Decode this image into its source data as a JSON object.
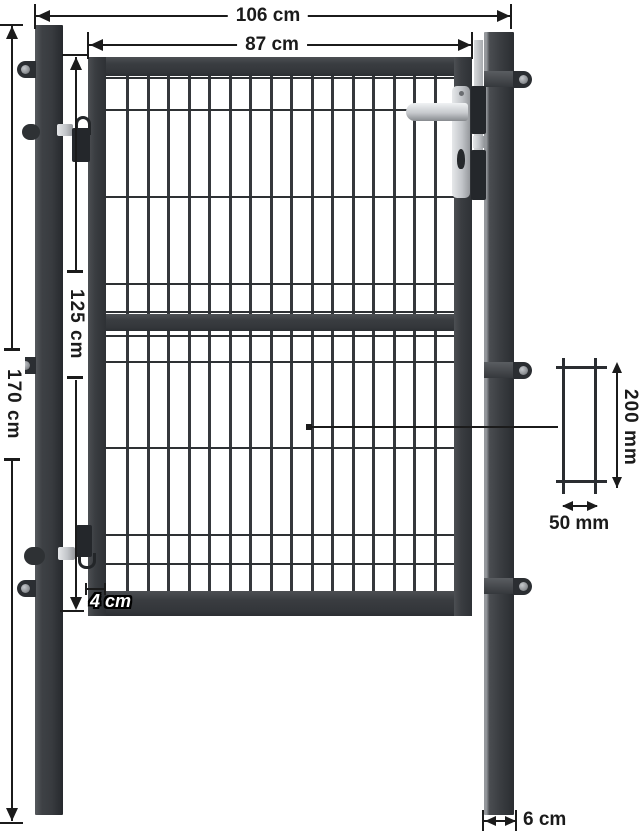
{
  "product": {
    "name": "Garden gate with two square posts and double-wire mesh infill",
    "view": "front elevation dimension diagram",
    "finish": "anthracite gray"
  },
  "labels": {
    "total_width": "106 cm",
    "gate_width": "87 cm",
    "post_height": "170 cm",
    "gate_height": "125 cm",
    "frame_tube_width": "4 cm",
    "post_width": "6 cm",
    "mesh_cell_height": "200 mm",
    "mesh_cell_width": "50 mm"
  },
  "colors": {
    "background": "#ffffff",
    "steel_dark": "#3b3e42",
    "steel_darker": "#2b2e32",
    "mesh_wire": "#2e3134",
    "silver_hardware": "#c9ccd0",
    "dimension_ink": "#1b1b1b",
    "outlined_label_fill": "#ffffff"
  },
  "mesh": {
    "vertical_bar_count": 16,
    "horizontal_wire_offsets": [
      1,
      33,
      120,
      207,
      235,
      259,
      285,
      371,
      458,
      487
    ]
  }
}
